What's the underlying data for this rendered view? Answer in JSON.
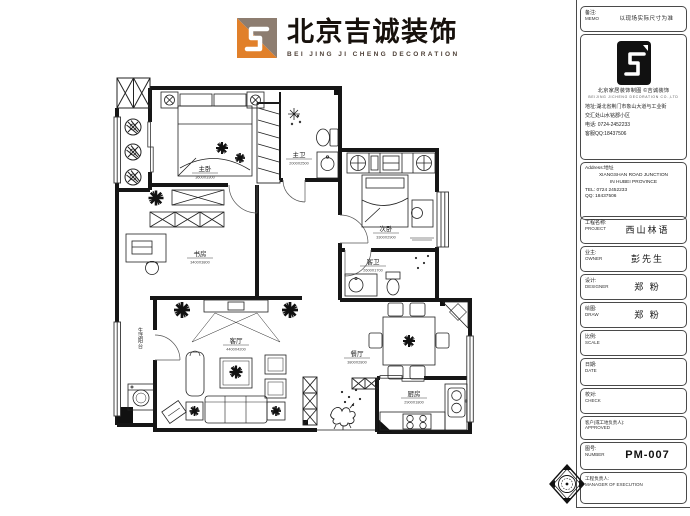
{
  "header": {
    "brand": "北京吉诚装饰",
    "brand_en": "BEI JING JI CHENG DECORATION"
  },
  "colors": {
    "logo_orange": "#e1802a",
    "logo_taupe": "#8d7d70",
    "ink": "#1c1c1c"
  },
  "titleblock": {
    "memo": {
      "label": "备注:",
      "en": "MEMO",
      "value": "以现场实际尺寸为准"
    },
    "company": {
      "line": "北京家居装饰制图 ©吉诚装饰",
      "line_en": "BEIJING JICHENG DECORATION CO.,LTD",
      "addr1": "地址:湖北省荆门市象山大道与工业街",
      "addr2": "交汇处山水铭郡小区",
      "tel": "电话: 0724-2452233",
      "qq": "客服QQ:18437506"
    },
    "contact_en": {
      "label": "Address:地址",
      "line1": "XIANGSHAN ROAD JUNCTION",
      "line2": "IN HUBEI PROVINCE",
      "tel": "TEL: 0724 2452233",
      "qq": "QQ: 18437506"
    },
    "fields": [
      {
        "label": "工程名称:",
        "en": "PROJECT",
        "value": "西山林语"
      },
      {
        "label": "业主:",
        "en": "OWNER",
        "value": "彭先生"
      },
      {
        "label": "设计:",
        "en": "DESIGNER",
        "value": "郑 粉"
      },
      {
        "label": "绘图:",
        "en": "DRAW",
        "value": "郑 粉"
      },
      {
        "label": "比例:",
        "en": "SCALE",
        "value": ""
      },
      {
        "label": "日期:",
        "en": "DATE",
        "value": ""
      },
      {
        "label": "校对:",
        "en": "CHECK",
        "value": ""
      },
      {
        "label": "客户(或工地负责人):",
        "en": "APPROVED",
        "value": ""
      },
      {
        "label": "图号:",
        "en": "NUMBER",
        "value": "PM-007"
      },
      {
        "label": "工程负责人:",
        "en": "MANAGER OF EXECUTION",
        "value": ""
      }
    ]
  },
  "plan": {
    "rooms": {
      "master": {
        "name": "主卧",
        "dims": "3600X3300"
      },
      "masterbath": {
        "name": "主卫",
        "dims": "2000X2500"
      },
      "second": {
        "name": "次卧",
        "dims": "3300X2900"
      },
      "guestbath": {
        "name": "客卫",
        "dims": "2600X1700"
      },
      "study": {
        "name": "书房",
        "dims": "3400X3800"
      },
      "living": {
        "name": "客厅",
        "dims": "4400X4200"
      },
      "dining": {
        "name": "餐厅",
        "dims": "3800X2800"
      },
      "kitchen": {
        "name": "厨房",
        "dims": "2900X1800"
      },
      "laundry": {
        "name": "生活阳台"
      }
    }
  }
}
